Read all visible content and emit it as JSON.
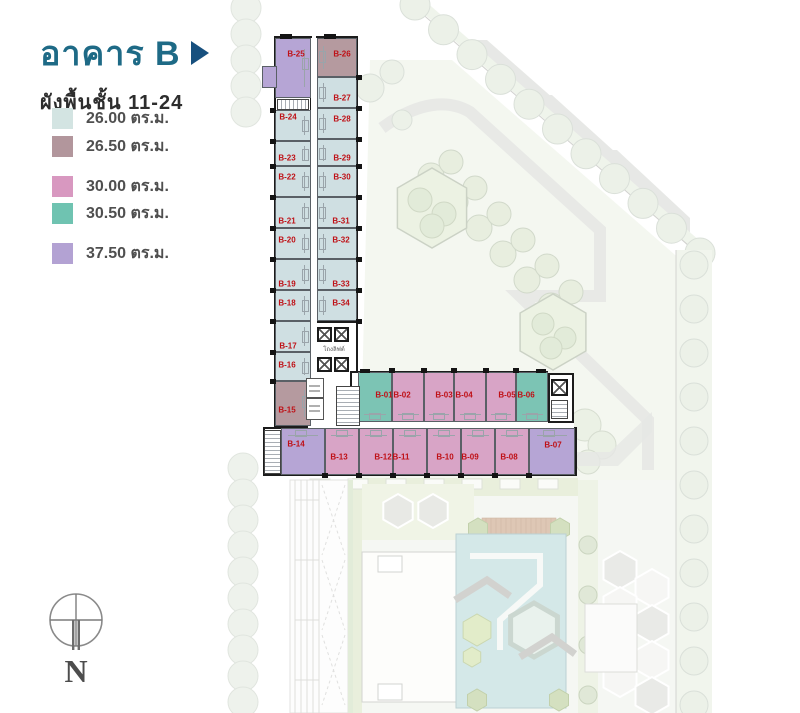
{
  "header": {
    "building_title": "อาคาร B",
    "floor_range": "ผังพื้นชั้น 11-24"
  },
  "legend": {
    "items": [
      {
        "area": "26.00 ตร.ม.",
        "key": "26.00",
        "color": "#d3e4e2",
        "fill": "#cfdfe2"
      },
      {
        "area": "26.50 ตร.ม.",
        "key": "26.50",
        "color": "#b2969c",
        "fill": "#b59a9f"
      },
      {
        "area": "30.00 ตร.ม.",
        "key": "30.00",
        "color": "#d898c0",
        "fill": "#d8a4c6"
      },
      {
        "area": "30.50 ตร.ม.",
        "key": "30.50",
        "color": "#6fc3b1",
        "fill": "#7cc4b4"
      },
      {
        "area": "37.50 ตร.ม.",
        "key": "37.50",
        "color": "#b3a2d3",
        "fill": "#b6a5d5"
      }
    ]
  },
  "plan": {
    "label_color": "#bf1016",
    "core": {
      "lift_lobby_label": "โถงลิฟต์"
    },
    "units": [
      {
        "id": "B-01",
        "size": "30.50"
      },
      {
        "id": "B-02",
        "size": "30.00"
      },
      {
        "id": "B-03",
        "size": "30.00"
      },
      {
        "id": "B-04",
        "size": "30.00"
      },
      {
        "id": "B-05",
        "size": "30.00"
      },
      {
        "id": "B-06",
        "size": "30.50"
      },
      {
        "id": "B-07",
        "size": "37.50"
      },
      {
        "id": "B-08",
        "size": "30.00"
      },
      {
        "id": "B-09",
        "size": "30.00"
      },
      {
        "id": "B-10",
        "size": "30.00"
      },
      {
        "id": "B-11",
        "size": "30.00"
      },
      {
        "id": "B-12",
        "size": "30.00"
      },
      {
        "id": "B-13",
        "size": "30.00"
      },
      {
        "id": "B-14",
        "size": "37.50"
      },
      {
        "id": "B-15",
        "size": "26.50"
      },
      {
        "id": "B-16",
        "size": "26.00"
      },
      {
        "id": "B-17",
        "size": "26.00"
      },
      {
        "id": "B-18",
        "size": "26.00"
      },
      {
        "id": "B-19",
        "size": "26.00"
      },
      {
        "id": "B-20",
        "size": "26.00"
      },
      {
        "id": "B-21",
        "size": "26.00"
      },
      {
        "id": "B-22",
        "size": "26.00"
      },
      {
        "id": "B-23",
        "size": "26.00"
      },
      {
        "id": "B-24",
        "size": "26.00"
      },
      {
        "id": "B-25",
        "size": "37.50"
      },
      {
        "id": "B-26",
        "size": "26.50"
      },
      {
        "id": "B-27",
        "size": "26.00"
      },
      {
        "id": "B-28",
        "size": "26.00"
      },
      {
        "id": "B-29",
        "size": "26.00"
      },
      {
        "id": "B-30",
        "size": "26.00"
      },
      {
        "id": "B-31",
        "size": "26.00"
      },
      {
        "id": "B-32",
        "size": "26.00"
      },
      {
        "id": "B-33",
        "size": "26.00"
      },
      {
        "id": "B-34",
        "size": "26.00"
      }
    ]
  },
  "compass": {
    "label": "N"
  }
}
